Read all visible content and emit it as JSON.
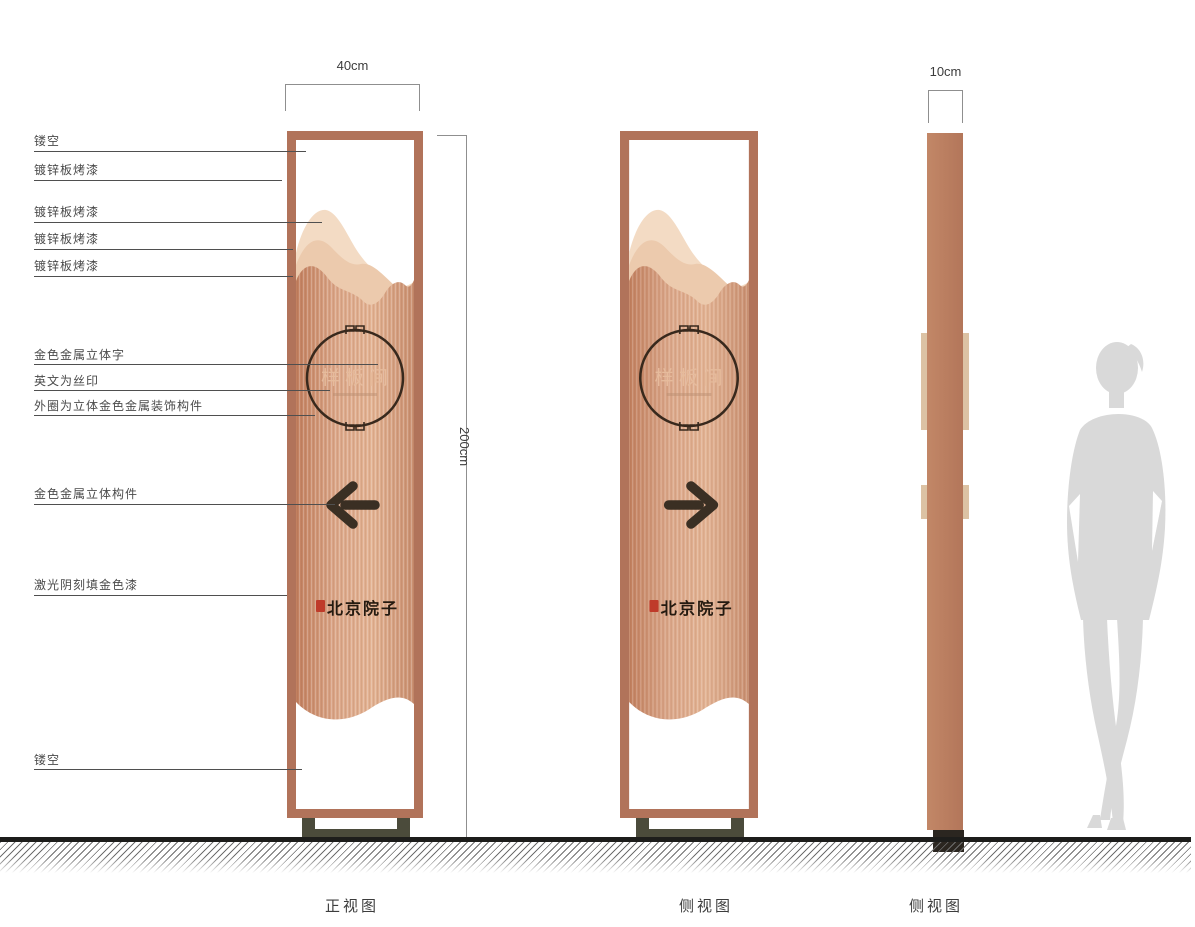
{
  "annotations": [
    {
      "text": "镂空"
    },
    {
      "text": "镀锌板烤漆"
    },
    {
      "text": "镀锌板烤漆"
    },
    {
      "text": "镀锌板烤漆"
    },
    {
      "text": "镀锌板烤漆"
    },
    {
      "text": "金色金属立体字"
    },
    {
      "text": "英文为丝印"
    },
    {
      "text": "外圈为立体金色金属装饰构件"
    },
    {
      "text": "金色金属立体构件"
    },
    {
      "text": "激光阴刻填金色漆"
    },
    {
      "text": "镂空"
    }
  ],
  "dimensions": {
    "front_width": "40cm",
    "height": "200cm",
    "side_width": "10cm"
  },
  "signage": {
    "room_label": "样板间",
    "brand": "北京院子"
  },
  "views": [
    {
      "label": "正视图"
    },
    {
      "label": "侧视图"
    },
    {
      "label": "侧视图"
    }
  ],
  "icons": [
    {
      "name": "left-arrow-icon"
    },
    {
      "name": "right-arrow-icon"
    },
    {
      "name": "red-seal-icon"
    },
    {
      "name": "circle-ornament-icon"
    },
    {
      "name": "human-silhouette"
    }
  ],
  "colors": {
    "frame_copper": "#b1735a",
    "panel_copper_light": "#e3b393",
    "panel_copper_dark": "#c2805f",
    "mountain_light": "#f3dbc4",
    "mountain_mid": "#eccaad",
    "detail_dark": "#3a2f23",
    "seal_red": "#bf3b2a",
    "base_olive": "#4b4b3b",
    "silhouette_gray": "#d9d9d9"
  }
}
